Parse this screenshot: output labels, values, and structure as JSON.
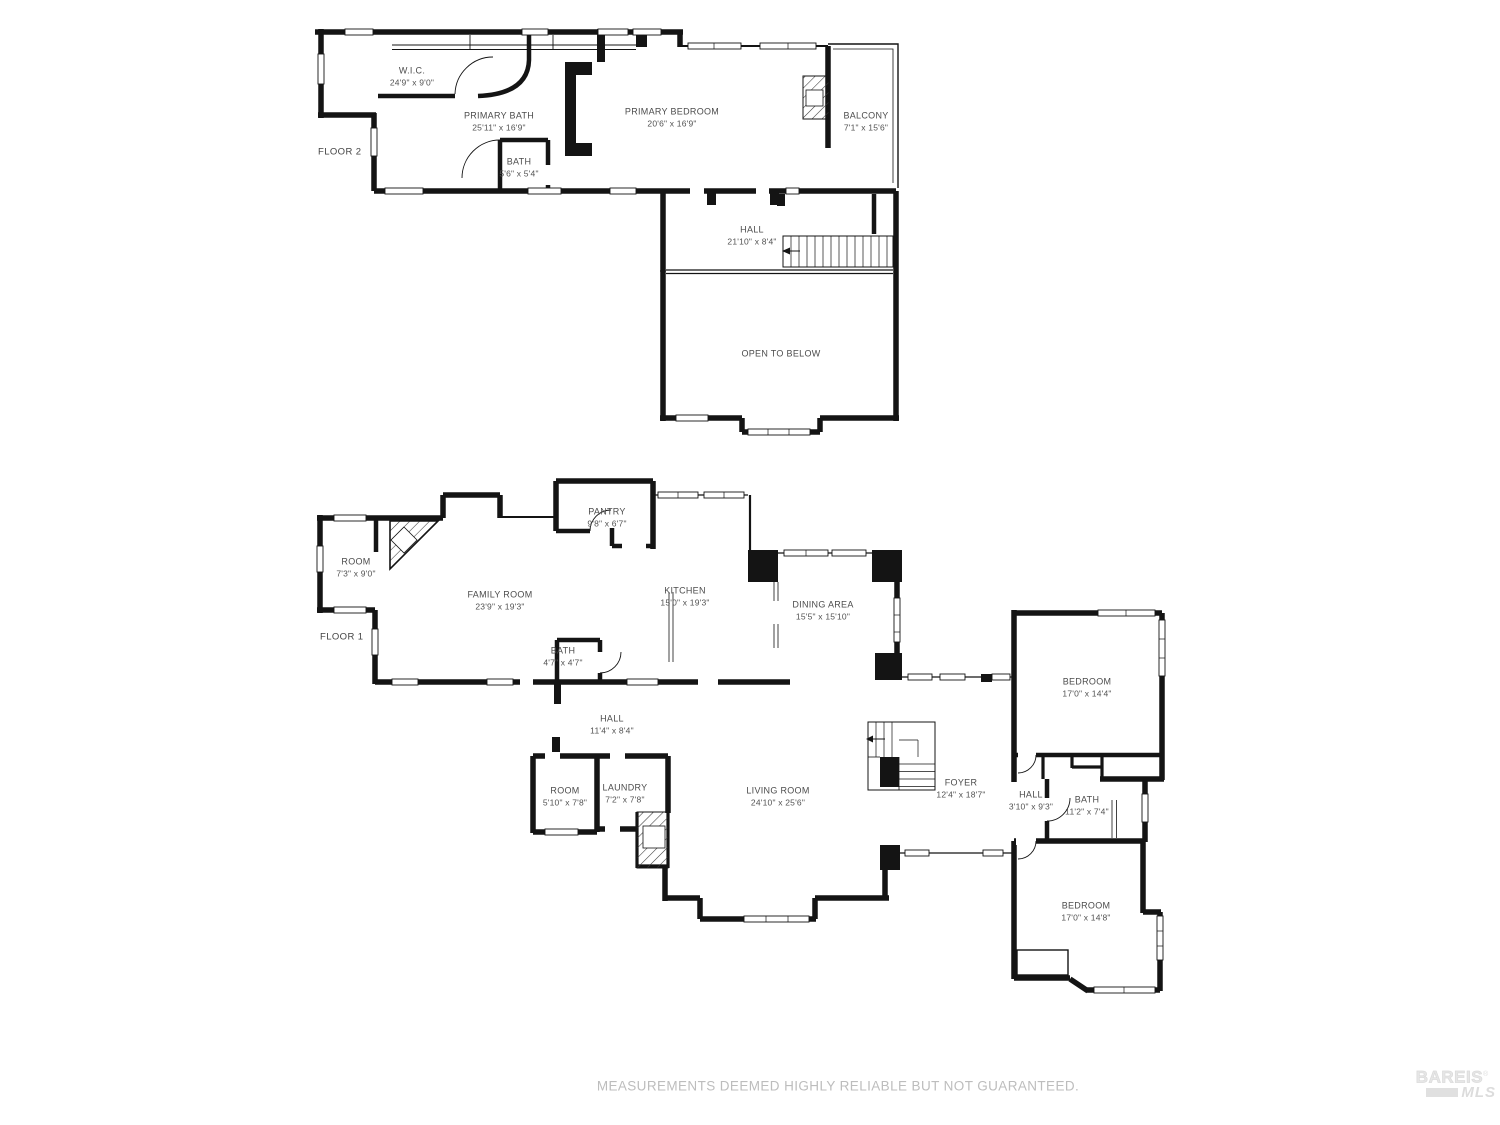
{
  "floor2": {
    "tag": "FLOOR 2",
    "rooms": {
      "wic": {
        "name": "W.I.C.",
        "dims": "24'9\" x 9'0\""
      },
      "primary_bath": {
        "name": "PRIMARY BATH",
        "dims": "25'11\" x 16'9\""
      },
      "bath": {
        "name": "BATH",
        "dims": "5'6\" x 5'4\""
      },
      "primary_bedroom": {
        "name": "PRIMARY BEDROOM",
        "dims": "20'6\" x 16'9\""
      },
      "balcony": {
        "name": "BALCONY",
        "dims": "7'1\" x 15'6\""
      },
      "hall": {
        "name": "HALL",
        "dims": "21'10\" x 8'4\""
      },
      "open_to_below": {
        "name": "OPEN TO BELOW"
      }
    }
  },
  "floor1": {
    "tag": "FLOOR 1",
    "rooms": {
      "room_upper": {
        "name": "ROOM",
        "dims": "7'3\" x 9'0\""
      },
      "family_room": {
        "name": "FAMILY ROOM",
        "dims": "23'9\" x 19'3\""
      },
      "pantry": {
        "name": "PANTRY",
        "dims": "9'8\" x 6'7\""
      },
      "kitchen": {
        "name": "KITCHEN",
        "dims": "15'0\" x 19'3\""
      },
      "bath_small": {
        "name": "BATH",
        "dims": "4'7\" x 4'7\""
      },
      "dining_area": {
        "name": "DINING AREA",
        "dims": "15'5\" x 15'10\""
      },
      "hall": {
        "name": "HALL",
        "dims": "11'4\" x 8'4\""
      },
      "room_small": {
        "name": "ROOM",
        "dims": "5'10\" x 7'8\""
      },
      "laundry": {
        "name": "LAUNDRY",
        "dims": "7'2\" x 7'8\""
      },
      "living_room": {
        "name": "LIVING ROOM",
        "dims": "24'10\" x 25'6\""
      },
      "foyer": {
        "name": "FOYER",
        "dims": "12'4\" x 18'7\""
      },
      "bedroom_upper": {
        "name": "BEDROOM",
        "dims": "17'0\" x 14'4\""
      },
      "hall_bed": {
        "name": "HALL",
        "dims": "3'10\" x 9'3\""
      },
      "bath_bed": {
        "name": "BATH",
        "dims": "11'2\" x 7'4\""
      },
      "bedroom_lower": {
        "name": "BEDROOM",
        "dims": "17'0\" x 14'8\""
      }
    }
  },
  "footer": {
    "disclaimer": "MEASUREMENTS DEEMED HIGHLY RELIABLE BUT NOT GUARANTEED."
  },
  "logo": {
    "brand": "BAREIS",
    "registered": "®",
    "sub": "MLS"
  },
  "colors": {
    "wall": "#141414",
    "label": "#4c4c4c",
    "disclaimer": "#bdbdbd",
    "logo": "#e0e0e0"
  }
}
